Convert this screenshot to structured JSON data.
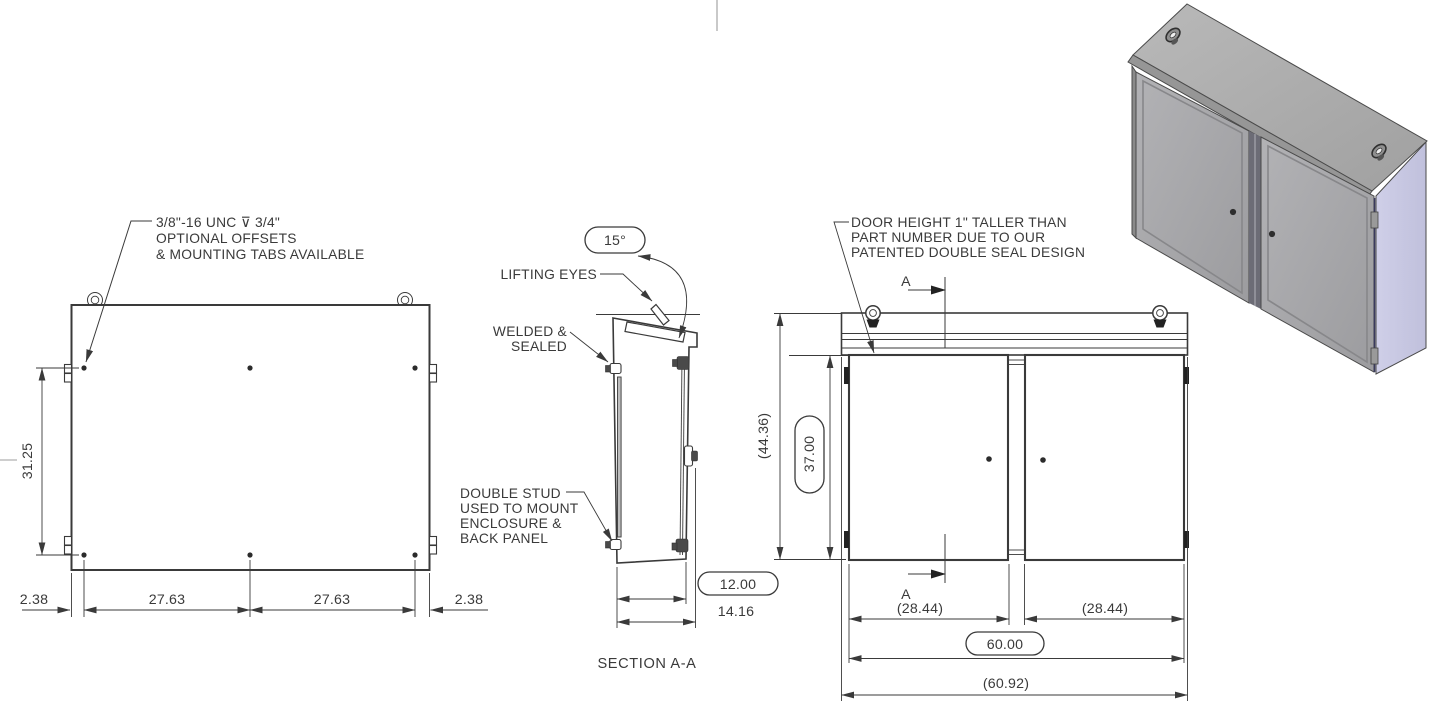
{
  "drawing": {
    "notes": {
      "thread1": "3/8\"-16 UNC ⊽ 3/4\"",
      "thread2": "OPTIONAL OFFSETS",
      "thread3": "& MOUNTING TABS AVAILABLE",
      "lifting": "LIFTING EYES",
      "welded1": "WELDED &",
      "welded2": "SEALED",
      "stud1": "DOUBLE STUD",
      "stud2": "USED TO MOUNT",
      "stud3": "ENCLOSURE &",
      "stud4": "BACK PANEL",
      "door1": "DOOR HEIGHT 1\" TALLER THAN",
      "door2": "PART NUMBER DUE TO OUR",
      "door3": "PATENTED DOUBLE SEAL DESIGN"
    },
    "back_view": {
      "height": "31.25",
      "offset_left": "2.38",
      "span_left": "27.63",
      "span_right": "27.63",
      "offset_right": "2.38"
    },
    "section_view": {
      "angle": "15°",
      "depth": "12.00",
      "overall_depth": "14.16",
      "label": "SECTION A-A"
    },
    "front_view": {
      "overall_height": "(44.36)",
      "door_height": "37.00",
      "door_width_left": "(28.44)",
      "door_width_right": "(28.44)",
      "width": "60.00",
      "overall_width": "(60.92)",
      "marker": "A"
    },
    "colors": {
      "line": "#3a3a3a",
      "roof_gray": "#ababab",
      "door_gray": "#a7a7aa",
      "side_lavender": "#c8c8e2",
      "background": "#ffffff"
    }
  }
}
